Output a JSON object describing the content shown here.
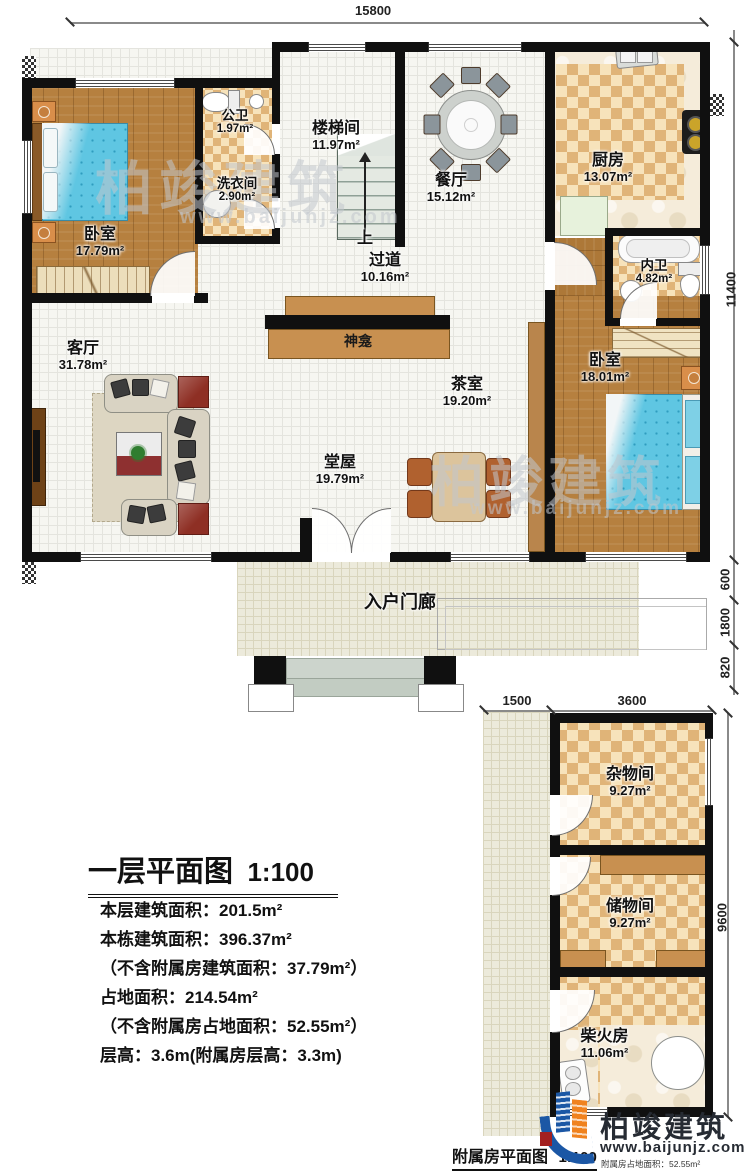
{
  "watermark": {
    "brand": "柏竣建筑",
    "url": "www.baijunjz.com"
  },
  "logo": {
    "brand": "柏竣建筑",
    "url": "www.baijunjz.com"
  },
  "dims": {
    "top": "15800",
    "right_total": "11400",
    "right_600": "600",
    "right_1800": "1800",
    "right_820": "820",
    "annex_left": "1500",
    "annex_right": "3600",
    "annex_height": "9600"
  },
  "stairs": {
    "up_label": "上"
  },
  "rooms": {
    "bedroom1": {
      "name": "卧室",
      "area": "17.79m²"
    },
    "public_bath": {
      "name": "公卫",
      "area": "1.97m²"
    },
    "laundry": {
      "name": "洗衣间",
      "area": "2.90m²"
    },
    "stairwell": {
      "name": "楼梯间",
      "area": "11.97m²"
    },
    "dining": {
      "name": "餐厅",
      "area": "15.12m²"
    },
    "kitchen": {
      "name": "厨房",
      "area": "13.07m²"
    },
    "inner_bath": {
      "name": "内卫",
      "area": "4.82m²"
    },
    "hallway": {
      "name": "过道",
      "area": "10.16m²"
    },
    "living": {
      "name": "客厅",
      "area": "31.78m²"
    },
    "shrine": {
      "name": "神龛"
    },
    "tea_room": {
      "name": "茶室",
      "area": "19.20m²"
    },
    "bedroom2": {
      "name": "卧室",
      "area": "18.01m²"
    },
    "main_hall": {
      "name": "堂屋",
      "area": "19.79m²"
    },
    "porch": {
      "name": "入户门廊"
    },
    "sundry": {
      "name": "杂物间",
      "area": "9.27m²"
    },
    "storage": {
      "name": "储物间",
      "area": "9.27m²"
    },
    "firewood": {
      "name": "柴火房",
      "area": "11.06m²"
    }
  },
  "title_block": {
    "title": "一层平面图",
    "scale": "1:100",
    "lines": [
      "本层建筑面积：201.5m²",
      "本栋建筑面积：396.37m²",
      "（不含附属房建筑面积：37.79m²）",
      "占地面积：214.54m²",
      "（不含附属房占地面积：52.55m²）",
      "层高：3.6m(附属房层高：3.3m)"
    ]
  },
  "annex_caption": {
    "label": "附属房平面图",
    "scale": "1:100",
    "note": "附属房占地面积：52.55m²"
  }
}
